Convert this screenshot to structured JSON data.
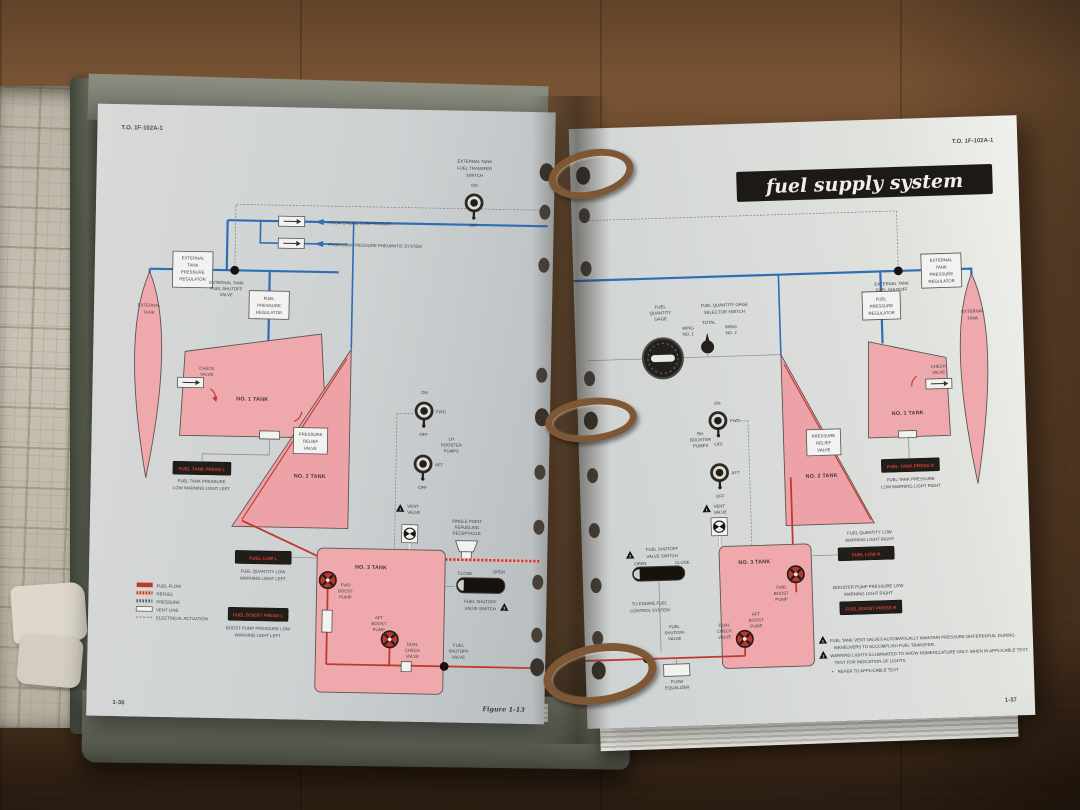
{
  "header": {
    "left": "T.O. 1F-102A-1",
    "right": "T.O. 1F-102A-1",
    "banner": "fuel supply system"
  },
  "footer": {
    "figure": "Figure 1-13",
    "page_left": "1-36",
    "page_right": "1-37"
  },
  "colors": {
    "line_blue": "#2f6db5",
    "line_red": "#c0392e",
    "tank_pink": "#efa9ad",
    "warn_text_red": "#cf4136",
    "banner_black": "#1c1917"
  },
  "top": {
    "transfer_switch": [
      "EXTERNAL TANK",
      "FUEL TRANSFER",
      "SWITCH"
    ],
    "on": "ON",
    "off": "OFF",
    "from_engine": "FROM ENGINE COMPRESSOR",
    "from_pneumatic": "FROM LOW-PRESSURE PNEUMATIC SYSTEM"
  },
  "left": {
    "ext_press_reg": [
      "EXTERNAL",
      "TANK",
      "PRESSURE",
      "REGULATOR"
    ],
    "ext_shutoff": [
      "EXTERNAL TANK",
      "FUEL SHUTOFF",
      "VALVE"
    ],
    "fuel_press_reg": [
      "FUEL",
      "PRESSURE",
      "REGULATOR"
    ],
    "external_tank": [
      "EXTERNAL",
      "TANK"
    ],
    "check_valve": [
      "CHECK",
      "VALVE"
    ],
    "tank1": "NO. 1 TANK",
    "tank2": "NO. 2 TANK",
    "tank3": "NO. 3 TANK",
    "press_relief": [
      "PRESSURE",
      "RELIEF",
      "VALVE"
    ],
    "press_light": "FUEL TANK PRESS L",
    "press_light_cap": [
      "FUEL TANK PRESSURE",
      "LOW WARNING LIGHT LEFT"
    ],
    "boosters": [
      "LH",
      "BOOSTER",
      "PUMPS"
    ],
    "on": "ON",
    "off": "OFF",
    "fwd": "FWD",
    "aft": "AFT",
    "vent_valve": [
      "VENT",
      "VALVE"
    ],
    "receptacle": [
      "SINGLE POINT",
      "REFUELING",
      "RECEPTACLE"
    ],
    "fuel_low": "FUEL LOW L",
    "fuel_low_cap": [
      "FUEL QUANTITY LOW",
      "WARNING LIGHT LEFT"
    ],
    "fwd_pump": [
      "FWD",
      "BOOST",
      "PUMP"
    ],
    "aft_pump": [
      "AFT",
      "BOOST",
      "PUMP"
    ],
    "boost_press": "FUEL BOOST PRESS L",
    "boost_press_cap": [
      "BOOST PUMP PRESSURE LOW",
      "WARNING LIGHT LEFT"
    ],
    "dual_check": [
      "DUAL",
      "CHECK",
      "VALVE"
    ],
    "close": "CLOSE",
    "open": "OPEN",
    "shutoff_switch": [
      "FUEL SHUTOFF",
      "VALVE SWITCH"
    ],
    "shutoff_valve": [
      "FUEL",
      "SHUTOFF",
      "VALVE"
    ]
  },
  "legend": {
    "items": [
      "FUEL FLOW",
      "REFUEL",
      "PRESSURE",
      "VENT LINE",
      "ELECTRICAL ACTUATION"
    ]
  },
  "right": {
    "gage": [
      "FUEL",
      "QUANTITY",
      "GAGE"
    ],
    "selector": [
      "FUEL QUANTITY GAGE",
      "SELECTOR SWITCH"
    ],
    "total": "TOTAL",
    "wing1": [
      "WING",
      "NO. 1"
    ],
    "wing2": [
      "WING",
      "NO. 2"
    ],
    "boosters": [
      "RH",
      "BOOSTER",
      "PUMPS"
    ],
    "on": "ON",
    "off": "OFF",
    "fwd": "FWD",
    "aft": "AFT",
    "vent_valve": [
      "VENT",
      "VALVE"
    ],
    "ext_press_reg": [
      "EXTERNAL",
      "TANK",
      "PRESSURE",
      "REGULATOR"
    ],
    "ext_shutoff": [
      "EXTERNAL TANK",
      "FUEL SHUTOFF",
      "VALVE"
    ],
    "fuel_press_reg": [
      "FUEL",
      "PRESSURE",
      "REGULATOR"
    ],
    "external_tank": [
      "EXTERNAL",
      "TANK"
    ],
    "check_valve": [
      "CHECK",
      "VALVE"
    ],
    "tank1": "NO. 1 TANK",
    "tank2": "NO. 2 TANK",
    "tank3": "NO. 3 TANK",
    "press_relief": [
      "PRESSURE",
      "RELIEF",
      "VALVE"
    ],
    "press_light": "FUEL TANK PRESS R",
    "press_light_cap": [
      "FUEL TANK PRESSURE",
      "LOW WARNING LIGHT RIGHT"
    ],
    "fuel_low_cap": [
      "FUEL QUANTITY LOW",
      "WARNING LIGHT RIGHT"
    ],
    "fuel_low": "FUEL LOW R",
    "fwd_pump": [
      "FWD",
      "BOOST",
      "PUMP"
    ],
    "aft_pump": [
      "AFT",
      "BOOST",
      "PUMP"
    ],
    "boost_press_cap": [
      "BOOSTER PUMP PRESSURE LOW",
      "WARNING LIGHT RIGHT"
    ],
    "boost_press": "FUEL BOOST PRESS R",
    "dual_check": [
      "DUAL",
      "CHECK",
      "VALVE"
    ],
    "open": "OPEN",
    "close": "CLOSE",
    "shutoff_switch": [
      "FUEL SHUTOFF",
      "VALVE SWITCH"
    ],
    "to_engine": [
      "TO ENGINE FUEL",
      "CONTROL SYSTEM"
    ],
    "shutoff_valve": [
      "FUEL",
      "SHUTOFF",
      "VALVE"
    ],
    "flow_equalizer": [
      "FLOW",
      "EQUALIZER"
    ]
  },
  "notes": {
    "m1": "1",
    "m2": "2",
    "n1": [
      "FUEL TANK VENT VALVES AUTOMATICALLY MAINTAIN PRESSURE DIFFERENTIAL DURING",
      "MANEUVERS TO ACCOMPLISH FUEL TRANSFER."
    ],
    "n2": [
      "WARNING LIGHTS ILLUMINATED TO SHOW NOMENCLATURE ONLY. WHEN IN APPLICABLE TEST,",
      "TEST FOR INDICATION OF LIGHTS."
    ],
    "bullet": "•",
    "n3": "REFER TO APPLICABLE TEXT"
  }
}
